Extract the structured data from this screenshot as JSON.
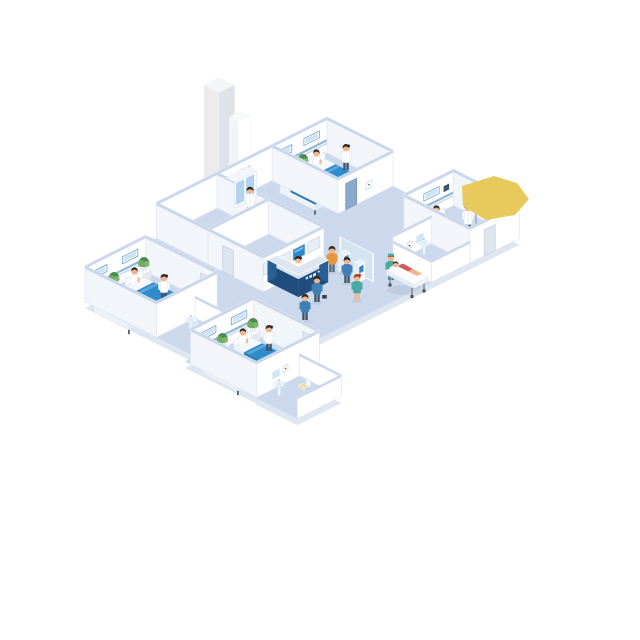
{
  "scene": {
    "description": "Isometric cutaway illustration of a hospital floor: four patient wards with beds, a central reception desk, self-service check-in kiosks, an imaging screen wall, utility room with elevator shaft, three bathrooms, staff, patients and a stretcher",
    "rooms": [
      {
        "id": "ward-top",
        "type": "patient-ward",
        "beds": 2,
        "occupants": [
          "patient-sitting",
          "patient-sitting",
          "nurse"
        ],
        "furniture": [
          "headboard-panel",
          "headboard-panel",
          "plant-nightstand",
          "door",
          "wall-art"
        ]
      },
      {
        "id": "ward-right",
        "type": "patient-ward",
        "beds": 1,
        "occupants": [
          "patient-sitting",
          "doctor"
        ],
        "furniture": [
          "headboard-panel",
          "wall-monitor",
          "plant-nightstand",
          "iv-stand",
          "door"
        ]
      },
      {
        "id": "ward-left",
        "type": "patient-ward",
        "beds": 2,
        "occupants": [
          "patient-sitting",
          "patient-sitting",
          "nurse"
        ],
        "furniture": [
          "headboard-panel",
          "headboard-panel",
          "plant-nightstand",
          "plant-nightstand",
          "door"
        ]
      },
      {
        "id": "ward-bottom",
        "type": "patient-ward",
        "beds": 2,
        "occupants": [
          "patient-sitting",
          "patient-sitting",
          "nurse"
        ],
        "furniture": [
          "headboard-panel",
          "headboard-panel",
          "plant-nightstand",
          "plant-nightstand",
          "door"
        ]
      },
      {
        "id": "utility-room",
        "type": "supply-room",
        "occupants": [
          "staff-white-coat"
        ],
        "furniture": [
          "medicine-cabinet",
          "elevator-shaft",
          "door"
        ]
      },
      {
        "id": "imaging-room",
        "type": "diagnostics-room",
        "wall_screens": 4,
        "active_screen_index": 2,
        "furniture": [
          "screen-wall",
          "door"
        ]
      },
      {
        "id": "bathroom-right",
        "type": "bathroom",
        "fixtures": [
          "sink",
          "toilet",
          "mirror",
          "wall-art"
        ]
      },
      {
        "id": "bathroom-left",
        "type": "bathroom",
        "fixtures": [
          "sink",
          "toilet-seat",
          "mirror",
          "wall-art"
        ]
      },
      {
        "id": "bathroom-bottom",
        "type": "bathroom",
        "fixtures": [
          "sink",
          "toilet",
          "mirror",
          "wall-art"
        ]
      },
      {
        "id": "lobby",
        "type": "reception-corridor",
        "furniture": [
          "reception-desk",
          "self-service-kiosk",
          "self-service-kiosk",
          "glass-partition",
          "stretcher"
        ],
        "occupants": [
          "receptionist",
          "kiosk-user-orange",
          "kiosk-user-blue",
          "man-with-briefcase",
          "walking-person-blue",
          "walking-nurse-redhair",
          "stretcher-nurse",
          "stretcher-patient"
        ]
      }
    ],
    "callout": {
      "id": "yellow-highlight",
      "shape": "irregular-polygon",
      "location": "over-right-ward"
    }
  },
  "palette": {
    "floor": "#ccd9ed",
    "floor_edge": "#dee6f1",
    "wall": "#ffffff",
    "wall_shade": "#f2f5fa",
    "wall_cap": "#c9d7ea",
    "rail": "#8fb8dc",
    "bed_blanket": "#2f8ccb",
    "bed_blanket_edge": "#2374b2",
    "bed_fold": "#5fa8da",
    "screen_blue": "#2f86c9",
    "desk_navy": "#1f4e7e",
    "desk_top": "#dde5f0",
    "glass": "#d6e7f4",
    "scrub_teal": "#49a8a2",
    "skin": "#f1b68f",
    "hair": "#2d2520",
    "plant_green": "#4c8a4f",
    "plant_light": "#6fae5e",
    "accent_yellow": "#e8c95c",
    "door_gray": "#dfe5ee",
    "door_blue": "#8aa9cd",
    "column_gray": "#e4e6ea",
    "red_accent": "#c0392b",
    "orange": "#e6953f",
    "blue_shirt": "#3f7fb5",
    "pants": "#3b5166"
  }
}
